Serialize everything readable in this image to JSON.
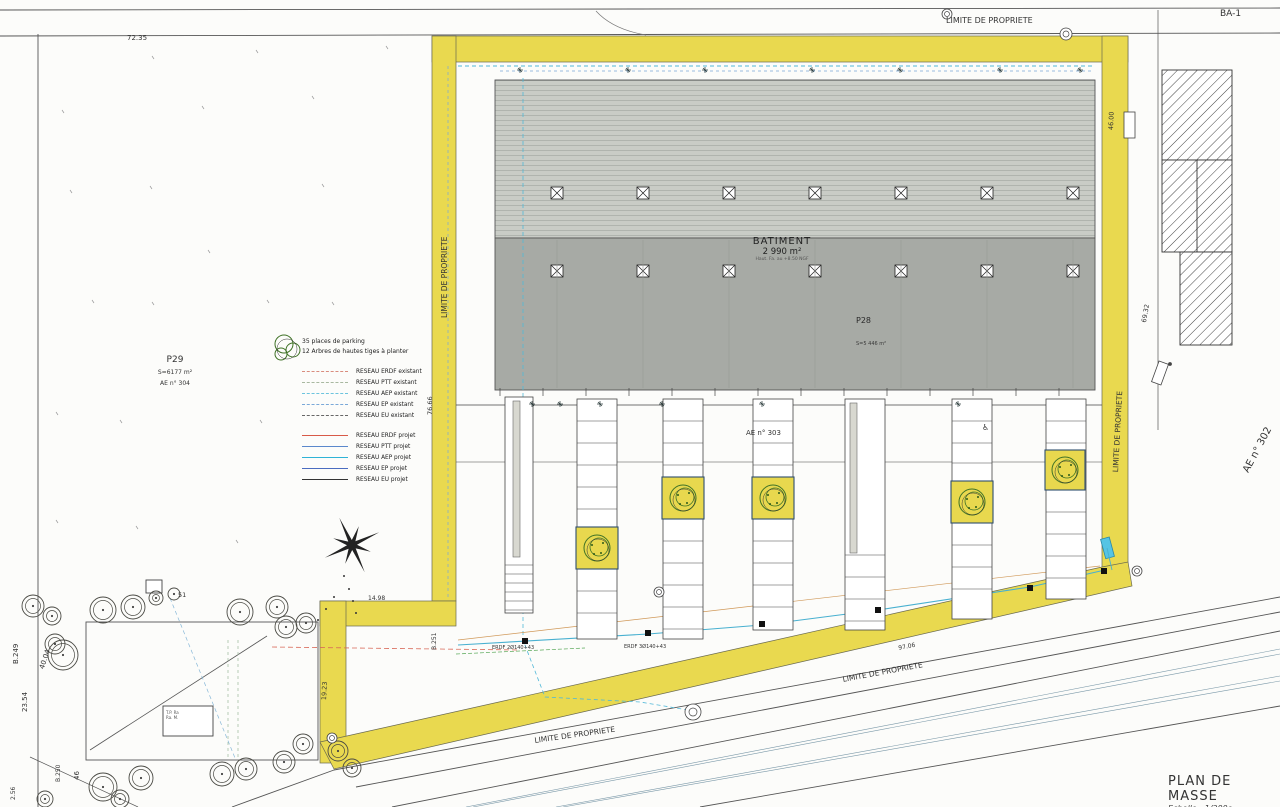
{
  "drawing": {
    "title": "PLAN DE MASSE",
    "scale": "Echelle : 1/200e"
  },
  "boundary": {
    "label": "LIMITE DE PROPRIETE"
  },
  "building": {
    "label": "BATIMENT",
    "area": "2 990 m²",
    "height_note": "Haut. Fa. au +8.50 NGF",
    "zone_label": "P28",
    "zone_area": "S=5 446 m²"
  },
  "parcels": {
    "p29_label": "P29",
    "p29_area": "S=6177 m²",
    "p29_ref": "AE n° 304",
    "ae303": "AE n° 303",
    "ae302": "AE n° 302",
    "ba1": "BA-1"
  },
  "legend": {
    "parking_note": "35 places de parking",
    "trees_note": "12 Arbres de hautes tiges à planter",
    "existant": [
      {
        "label": "RESEAU ERDF existant",
        "color": "#d98c7e"
      },
      {
        "label": "RESEAU PTT existant",
        "color": "#a8b8a0"
      },
      {
        "label": "RESEAU AEP existant",
        "color": "#6cc4de"
      },
      {
        "label": "RESEAU EP existant",
        "color": "#7aa8d8"
      },
      {
        "label": "RESEAU EU existant",
        "color": "#666666"
      }
    ],
    "projet": [
      {
        "label": "RESEAU ERDF projet",
        "color": "#d85a48"
      },
      {
        "label": "RESEAU PTT projet",
        "color": "#5b88cc"
      },
      {
        "label": "RESEAU AEP projet",
        "color": "#2fb3d6"
      },
      {
        "label": "RESEAU EP projet",
        "color": "#4a6cc0"
      },
      {
        "label": "RESEAU EU projet",
        "color": "#333333"
      }
    ]
  },
  "note_box": {
    "line1": "T.P. Ra",
    "line2": "Ra. M."
  },
  "annotations": [
    {
      "t": "LIMITE DE PROPRIETE",
      "x": 946,
      "y": 17,
      "r": 0,
      "fs": 8
    },
    {
      "t": "BA-1",
      "x": 1220,
      "y": 10,
      "r": 0,
      "fs": 9
    },
    {
      "t": "72.35",
      "x": 127,
      "y": 35,
      "r": 0,
      "fs": 7
    },
    {
      "t": "LIMITE DE PROPRIETE",
      "x": 441,
      "y": 318,
      "r": -90,
      "fs": 7.5
    },
    {
      "t": "76.66",
      "x": 427,
      "y": 415,
      "r": -90,
      "fs": 6.5
    },
    {
      "t": "LIMITE DE PROPRIETE",
      "x": 1112,
      "y": 472,
      "r": -87,
      "fs": 7.5
    },
    {
      "t": "69.32",
      "x": 1141,
      "y": 322,
      "r": -80,
      "fs": 6.5
    },
    {
      "t": "46.00",
      "x": 1108,
      "y": 130,
      "r": -88,
      "fs": 6.5
    },
    {
      "t": "AE n° 302",
      "x": 1242,
      "y": 470,
      "r": -62,
      "fs": 10
    },
    {
      "t": "97.06",
      "x": 898,
      "y": 646,
      "r": -11,
      "fs": 6
    },
    {
      "t": "LIMITE DE PROPRIETE",
      "x": 842,
      "y": 676,
      "r": -10.5,
      "fs": 7.5
    },
    {
      "t": "LIMITE DE PROPRIETE",
      "x": 534,
      "y": 737,
      "r": -8,
      "fs": 7.5
    },
    {
      "t": "14.98",
      "x": 368,
      "y": 596,
      "r": 0,
      "fs": 6
    },
    {
      "t": "B.251",
      "x": 432,
      "y": 650,
      "r": -90,
      "fs": 6
    },
    {
      "t": "51",
      "x": 178,
      "y": 592,
      "r": 0,
      "fs": 6.5
    },
    {
      "t": "B.249",
      "x": 13,
      "y": 664,
      "r": -90,
      "fs": 7
    },
    {
      "t": "40.04",
      "x": 39,
      "y": 668,
      "r": -72,
      "fs": 7
    },
    {
      "t": "23.54",
      "x": 22,
      "y": 712,
      "r": -90,
      "fs": 7
    },
    {
      "t": "B.250",
      "x": 56,
      "y": 782,
      "r": -90,
      "fs": 6
    },
    {
      "t": "46",
      "x": 74,
      "y": 780,
      "r": -90,
      "fs": 7
    },
    {
      "t": "2.56",
      "x": 11,
      "y": 800,
      "r": -90,
      "fs": 6
    },
    {
      "t": "19.23",
      "x": 321,
      "y": 700,
      "r": -87,
      "fs": 6.5
    },
    {
      "t": "ERDF 2Ø140+43",
      "x": 492,
      "y": 646,
      "r": 0,
      "fs": 5
    },
    {
      "t": "ERDF 3Ø140+43",
      "x": 624,
      "y": 645,
      "r": 0,
      "fs": 5
    },
    {
      "t": "♿",
      "x": 982,
      "y": 424,
      "r": 0,
      "fs": 8
    }
  ]
}
